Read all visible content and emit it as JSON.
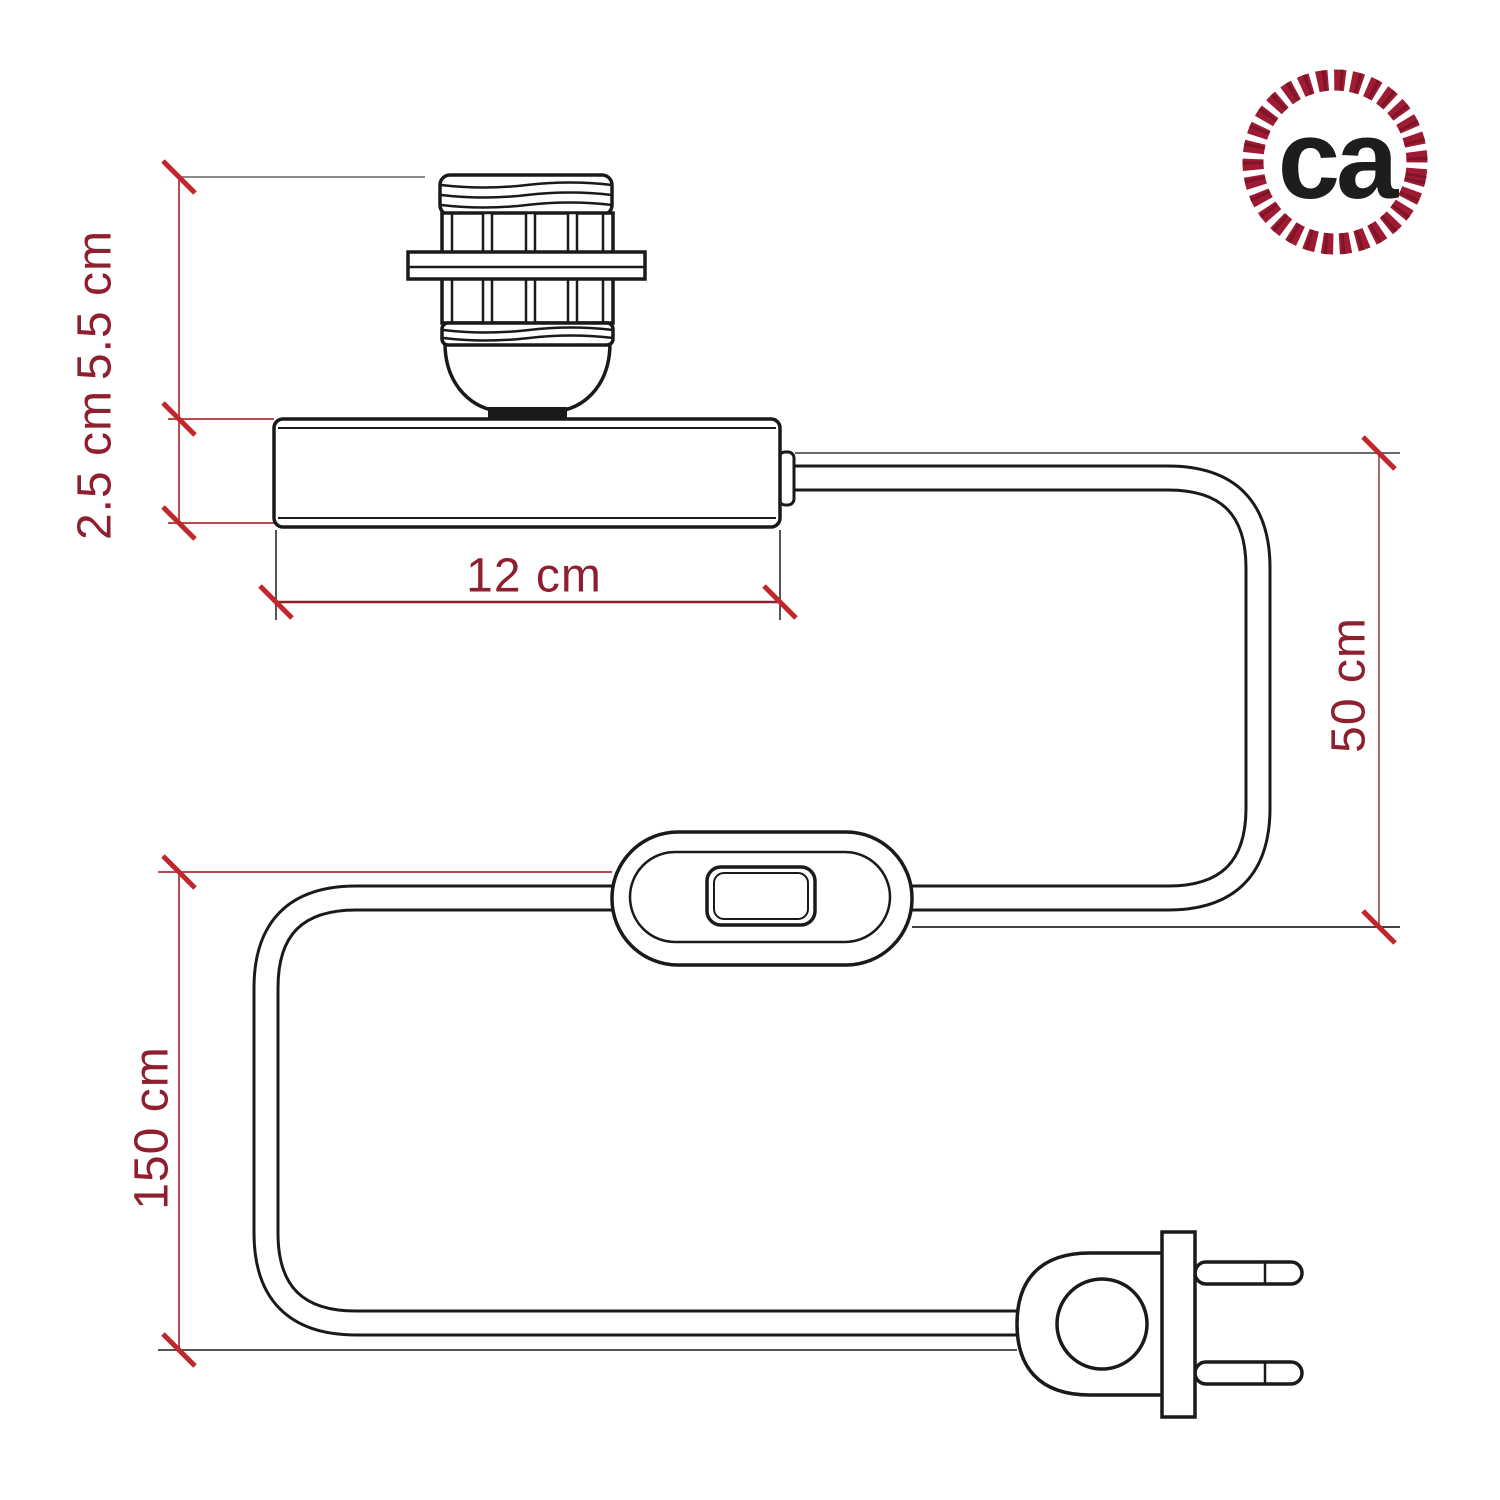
{
  "diagram": {
    "kind": "lamp-base-dimensional-drawing",
    "dimensions": {
      "socket_height": "5.5 cm",
      "base_height": "2.5 cm",
      "base_width": "12 cm",
      "base_to_switch": "50 cm",
      "cable_total": "150 cm"
    },
    "colors": {
      "object_line": "#1a1a1a",
      "dimension_text": "#8e1f2e",
      "dimension_line_red": "#bb4a4a",
      "dimension_line_gray": "#6b6b6b",
      "tick": "#c0272d",
      "background": "#ffffff",
      "logo_ring": "#9e1b33",
      "logo_text": "#1d1d1b"
    }
  },
  "logo": {
    "text": "ca"
  }
}
